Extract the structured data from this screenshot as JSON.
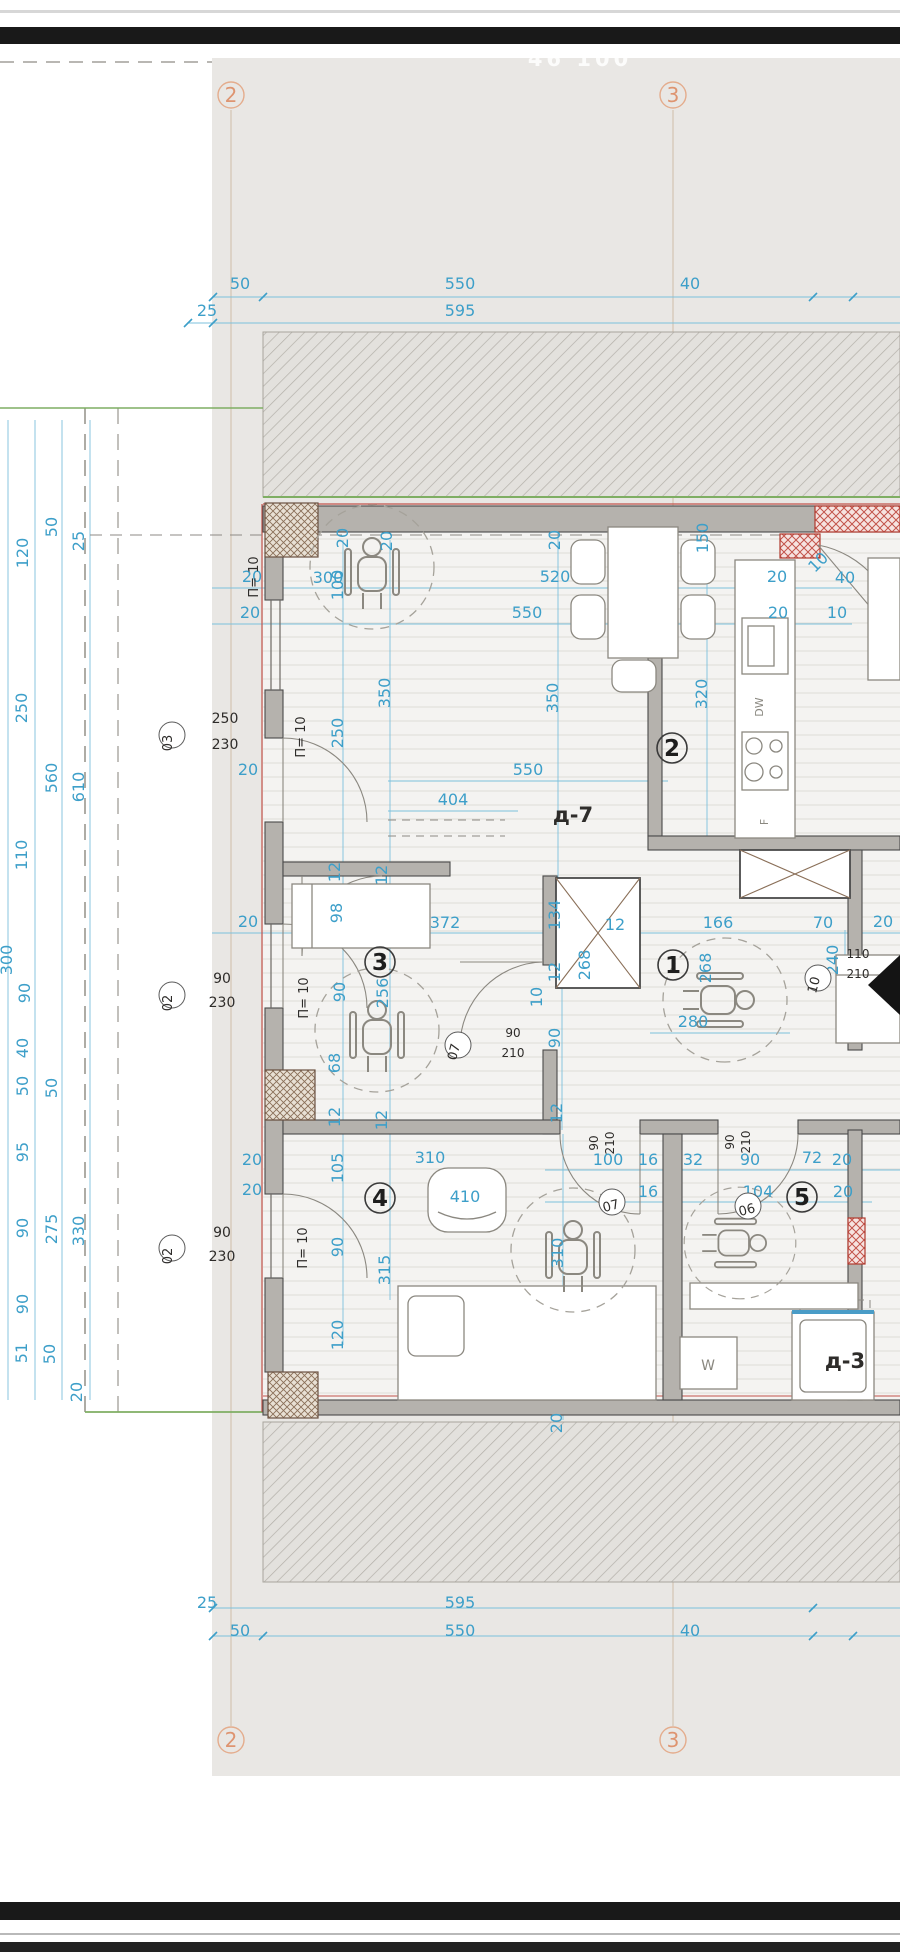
{
  "viewer": {
    "watermark": "46 100",
    "plan_title": "apartment floor plan"
  },
  "axis_markers": [
    {
      "t": "2",
      "x": 231,
      "y": 95
    },
    {
      "t": "3",
      "x": 673,
      "y": 95
    },
    {
      "t": "2",
      "x": 231,
      "y": 1740
    },
    {
      "t": "3",
      "x": 673,
      "y": 1740
    }
  ],
  "rooms": [
    {
      "t": "1",
      "x": 673,
      "y": 965
    },
    {
      "t": "2",
      "x": 672,
      "y": 748
    },
    {
      "t": "3",
      "x": 380,
      "y": 962
    },
    {
      "t": "4",
      "x": 380,
      "y": 1198
    },
    {
      "t": "5",
      "x": 802,
      "y": 1197
    }
  ],
  "tags": [
    {
      "t": "07",
      "x": 458,
      "y": 1045,
      "r": -75
    },
    {
      "t": "07",
      "x": 612,
      "y": 1202,
      "r": -15
    },
    {
      "t": "06",
      "x": 748,
      "y": 1206,
      "r": -15
    },
    {
      "t": "03",
      "x": 172,
      "y": 735,
      "r": -90
    },
    {
      "t": "02",
      "x": 172,
      "y": 995,
      "r": -90
    },
    {
      "t": "02",
      "x": 172,
      "y": 1248,
      "r": -90
    },
    {
      "t": "10",
      "x": 818,
      "y": 978,
      "r": -75
    }
  ],
  "dim_labels": [
    {
      "t": "50",
      "x": 240,
      "y": 289
    },
    {
      "t": "550",
      "x": 460,
      "y": 289
    },
    {
      "t": "40",
      "x": 690,
      "y": 289
    },
    {
      "t": "25",
      "x": 207,
      "y": 316
    },
    {
      "t": "595",
      "x": 460,
      "y": 316
    },
    {
      "t": "120",
      "x": 28,
      "y": 553,
      "r": -90
    },
    {
      "t": "50",
      "x": 57,
      "y": 527,
      "r": -90
    },
    {
      "t": "25",
      "x": 84,
      "y": 541,
      "r": -90
    },
    {
      "t": "250",
      "x": 27,
      "y": 708,
      "r": -90
    },
    {
      "t": "560",
      "x": 57,
      "y": 778,
      "r": -90
    },
    {
      "t": "610",
      "x": 84,
      "y": 787,
      "r": -90
    },
    {
      "t": "110",
      "x": 27,
      "y": 855,
      "r": -90
    },
    {
      "t": "300",
      "x": 12,
      "y": 960,
      "r": -90
    },
    {
      "t": "90",
      "x": 30,
      "y": 993,
      "r": -90
    },
    {
      "t": "40",
      "x": 28,
      "y": 1048,
      "r": -90
    },
    {
      "t": "50",
      "x": 28,
      "y": 1086,
      "r": -90
    },
    {
      "t": "50",
      "x": 57,
      "y": 1088,
      "r": -90
    },
    {
      "t": "95",
      "x": 28,
      "y": 1152,
      "r": -90
    },
    {
      "t": "90",
      "x": 28,
      "y": 1228,
      "r": -90
    },
    {
      "t": "275",
      "x": 57,
      "y": 1229,
      "r": -90
    },
    {
      "t": "330",
      "x": 84,
      "y": 1231,
      "r": -90
    },
    {
      "t": "90",
      "x": 28,
      "y": 1304,
      "r": -90
    },
    {
      "t": "51",
      "x": 27,
      "y": 1353,
      "r": -90
    },
    {
      "t": "50",
      "x": 55,
      "y": 1354,
      "r": -90
    },
    {
      "t": "20",
      "x": 82,
      "y": 1392,
      "r": -90
    },
    {
      "t": "20",
      "x": 252,
      "y": 582
    },
    {
      "t": "20",
      "x": 250,
      "y": 618
    },
    {
      "t": "300",
      "x": 328,
      "y": 583
    },
    {
      "t": "100",
      "x": 343,
      "y": 585,
      "r": -90
    },
    {
      "t": "20",
      "x": 348,
      "y": 538,
      "r": -90
    },
    {
      "t": "20",
      "x": 392,
      "y": 541,
      "r": -90
    },
    {
      "t": "520",
      "x": 555,
      "y": 582
    },
    {
      "t": "550",
      "x": 527,
      "y": 618
    },
    {
      "t": "20",
      "x": 560,
      "y": 540,
      "r": -90
    },
    {
      "t": "150",
      "x": 708,
      "y": 538,
      "r": -90
    },
    {
      "t": "20",
      "x": 777,
      "y": 582
    },
    {
      "t": "40",
      "x": 845,
      "y": 583
    },
    {
      "t": "20",
      "x": 778,
      "y": 618
    },
    {
      "t": "10",
      "x": 837,
      "y": 618
    },
    {
      "t": "10",
      "x": 822,
      "y": 566,
      "r": -45
    },
    {
      "t": "320",
      "x": 707,
      "y": 694,
      "r": -90
    },
    {
      "t": "350",
      "x": 390,
      "y": 693,
      "r": -90
    },
    {
      "t": "350",
      "x": 558,
      "y": 698,
      "r": -90
    },
    {
      "t": "550",
      "x": 528,
      "y": 775
    },
    {
      "t": "404",
      "x": 453,
      "y": 805
    },
    {
      "t": "250",
      "x": 343,
      "y": 733,
      "r": -90
    },
    {
      "t": "20",
      "x": 248,
      "y": 775
    },
    {
      "t": "20",
      "x": 248,
      "y": 927
    },
    {
      "t": "12",
      "x": 340,
      "y": 872,
      "r": -90
    },
    {
      "t": "12",
      "x": 387,
      "y": 875,
      "r": -90
    },
    {
      "t": "98",
      "x": 342,
      "y": 913,
      "r": -90
    },
    {
      "t": "372",
      "x": 445,
      "y": 928
    },
    {
      "t": "134",
      "x": 560,
      "y": 915,
      "r": -90
    },
    {
      "t": "12",
      "x": 615,
      "y": 930
    },
    {
      "t": "268",
      "x": 590,
      "y": 965,
      "r": -90
    },
    {
      "t": "12",
      "x": 560,
      "y": 972,
      "r": -90
    },
    {
      "t": "166",
      "x": 718,
      "y": 928
    },
    {
      "t": "70",
      "x": 823,
      "y": 928
    },
    {
      "t": "20",
      "x": 883,
      "y": 927
    },
    {
      "t": "240",
      "x": 838,
      "y": 960,
      "r": -90
    },
    {
      "t": "280",
      "x": 693,
      "y": 1027
    },
    {
      "t": "268",
      "x": 711,
      "y": 968,
      "r": -90
    },
    {
      "t": "10",
      "x": 542,
      "y": 997,
      "r": -90
    },
    {
      "t": "90",
      "x": 560,
      "y": 1038,
      "r": -90
    },
    {
      "t": "90",
      "x": 345,
      "y": 992,
      "r": -90
    },
    {
      "t": "256",
      "x": 388,
      "y": 993,
      "r": -90
    },
    {
      "t": "68",
      "x": 340,
      "y": 1063,
      "r": -90
    },
    {
      "t": "12",
      "x": 340,
      "y": 1117,
      "r": -90
    },
    {
      "t": "12",
      "x": 387,
      "y": 1120,
      "r": -90
    },
    {
      "t": "105",
      "x": 343,
      "y": 1168,
      "r": -90
    },
    {
      "t": "310",
      "x": 430,
      "y": 1163
    },
    {
      "t": "12",
      "x": 562,
      "y": 1113,
      "r": -90
    },
    {
      "t": "100",
      "x": 608,
      "y": 1165
    },
    {
      "t": "16",
      "x": 648,
      "y": 1165
    },
    {
      "t": "32",
      "x": 693,
      "y": 1165
    },
    {
      "t": "90",
      "x": 750,
      "y": 1165
    },
    {
      "t": "72",
      "x": 812,
      "y": 1163
    },
    {
      "t": "20",
      "x": 842,
      "y": 1165
    },
    {
      "t": "16",
      "x": 648,
      "y": 1197
    },
    {
      "t": "104",
      "x": 758,
      "y": 1197
    },
    {
      "t": "20",
      "x": 843,
      "y": 1197
    },
    {
      "t": "90",
      "x": 343,
      "y": 1247,
      "r": -90
    },
    {
      "t": "315",
      "x": 390,
      "y": 1270,
      "r": -90
    },
    {
      "t": "120",
      "x": 343,
      "y": 1335,
      "r": -90
    },
    {
      "t": "310",
      "x": 563,
      "y": 1253,
      "r": -90
    },
    {
      "t": "20",
      "x": 562,
      "y": 1423,
      "r": -90
    },
    {
      "t": "410",
      "x": 465,
      "y": 1202
    },
    {
      "t": "20",
      "x": 252,
      "y": 1165
    },
    {
      "t": "20",
      "x": 252,
      "y": 1195
    },
    {
      "t": "25",
      "x": 207,
      "y": 1608
    },
    {
      "t": "595",
      "x": 460,
      "y": 1608
    },
    {
      "t": "50",
      "x": 240,
      "y": 1636
    },
    {
      "t": "550",
      "x": 460,
      "y": 1636
    },
    {
      "t": "40",
      "x": 690,
      "y": 1636
    }
  ],
  "black_labels": [
    {
      "t": "П= 10",
      "x": 258,
      "y": 577,
      "r": -90
    },
    {
      "t": "П= 10",
      "x": 305,
      "y": 737,
      "r": -90
    },
    {
      "t": "П= 10",
      "x": 308,
      "y": 998,
      "r": -90
    },
    {
      "t": "П= 10",
      "x": 307,
      "y": 1248,
      "r": -90
    },
    {
      "t": "250",
      "x": 225,
      "y": 723,
      "s": 14
    },
    {
      "t": "230",
      "x": 225,
      "y": 749,
      "s": 14
    },
    {
      "t": "90",
      "x": 222,
      "y": 983,
      "s": 14
    },
    {
      "t": "230",
      "x": 222,
      "y": 1007,
      "s": 14
    },
    {
      "t": "90",
      "x": 222,
      "y": 1237,
      "s": 14
    },
    {
      "t": "230",
      "x": 222,
      "y": 1261,
      "s": 14
    },
    {
      "t": "90",
      "x": 513,
      "y": 1037,
      "s": 12
    },
    {
      "t": "210",
      "x": 513,
      "y": 1057,
      "s": 12
    },
    {
      "t": "90",
      "x": 598,
      "y": 1143,
      "r": -90,
      "s": 12
    },
    {
      "t": "210",
      "x": 614,
      "y": 1143,
      "r": -90,
      "s": 12
    },
    {
      "t": "90",
      "x": 734,
      "y": 1142,
      "r": -90,
      "s": 12
    },
    {
      "t": "210",
      "x": 750,
      "y": 1142,
      "r": -90,
      "s": 12
    },
    {
      "t": "110",
      "x": 858,
      "y": 958,
      "s": 12
    },
    {
      "t": "210",
      "x": 858,
      "y": 978,
      "s": 12
    },
    {
      "t": "д-7",
      "x": 573,
      "y": 822,
      "s": 21,
      "b": 1
    },
    {
      "t": "д-3",
      "x": 845,
      "y": 1368,
      "s": 21,
      "b": 1
    },
    {
      "t": "W",
      "x": 708,
      "y": 1370,
      "s": 14,
      "c": "#8a8880"
    },
    {
      "t": "DW",
      "x": 763,
      "y": 707,
      "r": -90,
      "s": 11,
      "c": "#8a8880"
    },
    {
      "t": "F",
      "x": 768,
      "y": 822,
      "r": -90,
      "s": 11,
      "c": "#8a8880"
    }
  ]
}
